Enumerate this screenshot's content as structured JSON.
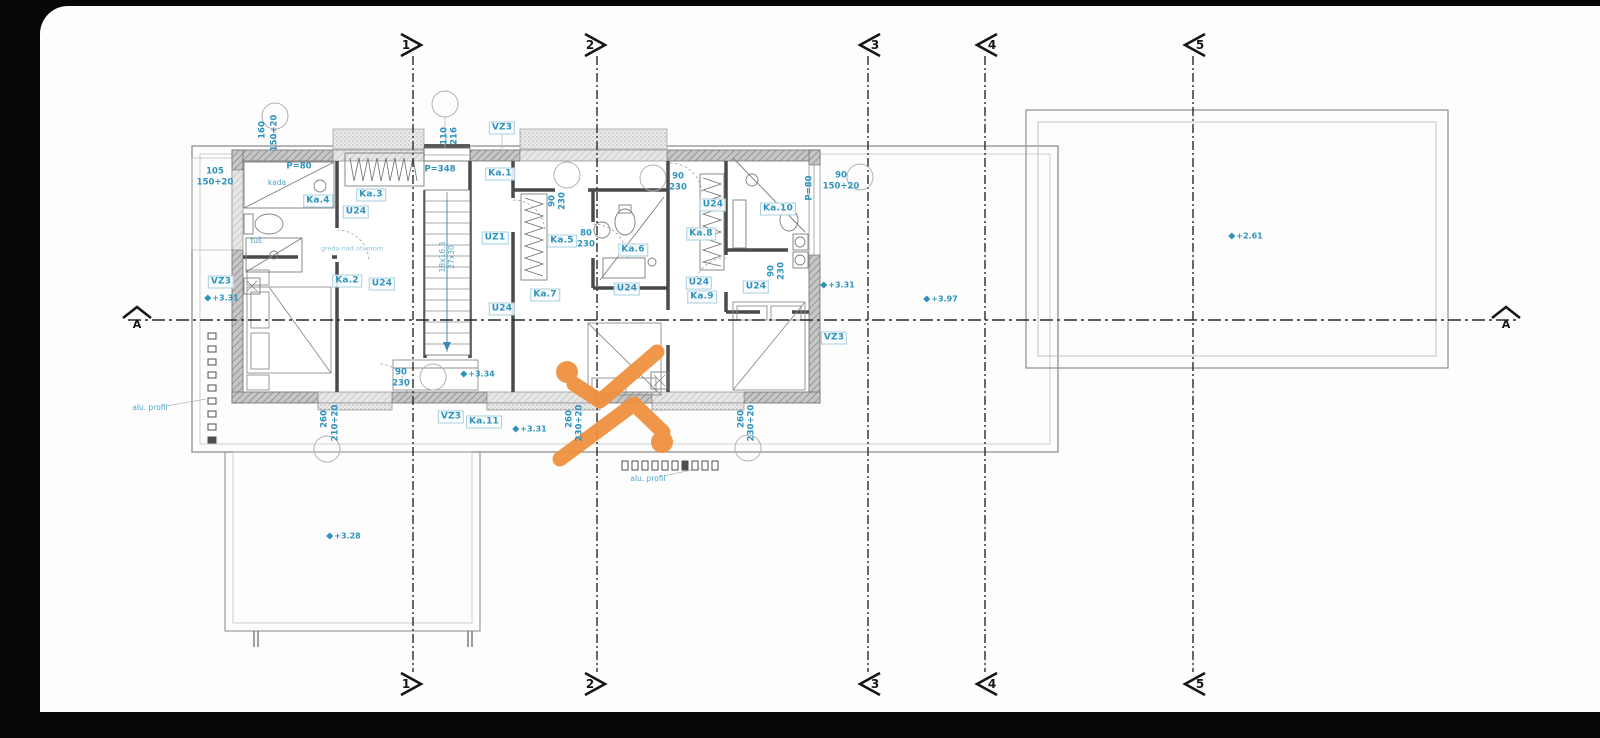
{
  "meta": {
    "drawing_type": "floor-plan",
    "annotation_color": "#2e93bd",
    "line_color": "#3c3c3c",
    "watermark_color": "#f0913f",
    "sheet_bg": "#fdfdfd",
    "frame_bg": "#060606"
  },
  "grid": {
    "vertical_axes": [
      {
        "label": "1",
        "x": 413,
        "dir": "right"
      },
      {
        "label": "2",
        "x": 597,
        "dir": "right"
      },
      {
        "label": "3",
        "x": 868,
        "dir": "left"
      },
      {
        "label": "4",
        "x": 985,
        "dir": "left"
      },
      {
        "label": "5",
        "x": 1193,
        "dir": "left"
      }
    ],
    "y_top_marker": 45,
    "y_bottom_marker": 684,
    "line_top": 56,
    "line_bottom": 672,
    "section_axis": {
      "label": "A",
      "y": 320,
      "x_start": 128,
      "x_end": 1516,
      "marker_left_x": 137,
      "marker_right_x": 1506
    }
  },
  "reference_circles": [
    {
      "x": 275,
      "y": 116
    },
    {
      "x": 445,
      "y": 104
    },
    {
      "x": 567,
      "y": 175
    },
    {
      "x": 653,
      "y": 178
    },
    {
      "x": 860,
      "y": 177
    },
    {
      "x": 433,
      "y": 377
    },
    {
      "x": 327,
      "y": 449
    },
    {
      "x": 748,
      "y": 448
    }
  ],
  "annotations": [
    {
      "text": "Ka.4",
      "x": 318,
      "y": 201,
      "style": "box"
    },
    {
      "text": "Ka.3",
      "x": 371,
      "y": 195,
      "style": "box"
    },
    {
      "text": "U24",
      "x": 356,
      "y": 212,
      "style": "box"
    },
    {
      "text": "Ka.2",
      "x": 347,
      "y": 281,
      "style": "box"
    },
    {
      "text": "U24",
      "x": 382,
      "y": 284,
      "style": "box"
    },
    {
      "text": "VZ3",
      "x": 221,
      "y": 282,
      "style": "box"
    },
    {
      "text": "Ka.1",
      "x": 500,
      "y": 174,
      "style": "box"
    },
    {
      "text": "VZ3",
      "x": 502,
      "y": 128,
      "style": "box"
    },
    {
      "text": "UZ1",
      "x": 495,
      "y": 238,
      "style": "box"
    },
    {
      "text": "U24",
      "x": 502,
      "y": 309,
      "style": "box"
    },
    {
      "text": "Ka.5",
      "x": 562,
      "y": 241,
      "style": "box"
    },
    {
      "text": "Ka.7",
      "x": 545,
      "y": 295,
      "style": "box"
    },
    {
      "text": "Ka.6",
      "x": 633,
      "y": 250,
      "style": "box"
    },
    {
      "text": "U24",
      "x": 627,
      "y": 289,
      "style": "box"
    },
    {
      "text": "U24",
      "x": 713,
      "y": 205,
      "style": "box"
    },
    {
      "text": "Ka.8",
      "x": 701,
      "y": 234,
      "style": "box"
    },
    {
      "text": "Ka.10",
      "x": 778,
      "y": 209,
      "style": "box"
    },
    {
      "text": "U24",
      "x": 756,
      "y": 287,
      "style": "box"
    },
    {
      "text": "U24",
      "x": 699,
      "y": 283,
      "style": "box"
    },
    {
      "text": "Ka.9",
      "x": 702,
      "y": 297,
      "style": "box"
    },
    {
      "text": "VZ3",
      "x": 451,
      "y": 417,
      "style": "box"
    },
    {
      "text": "Ka.11",
      "x": 484,
      "y": 422,
      "style": "box"
    },
    {
      "text": "VZ3",
      "x": 834,
      "y": 338,
      "style": "box"
    },
    {
      "text": "105",
      "x": 215,
      "y": 172,
      "style": "dim"
    },
    {
      "text": "150+20",
      "x": 215,
      "y": 183,
      "style": "dim"
    },
    {
      "text": "P=80",
      "x": 299,
      "y": 167,
      "style": "dim"
    },
    {
      "text": "P=348",
      "x": 440,
      "y": 170,
      "style": "dim"
    },
    {
      "text": "90",
      "x": 678,
      "y": 177,
      "style": "dim"
    },
    {
      "text": "230",
      "x": 678,
      "y": 188,
      "style": "dim"
    },
    {
      "text": "80",
      "x": 586,
      "y": 234,
      "style": "dim"
    },
    {
      "text": "230",
      "x": 586,
      "y": 245,
      "style": "dim"
    },
    {
      "text": "90",
      "x": 401,
      "y": 373,
      "style": "dim"
    },
    {
      "text": "230",
      "x": 401,
      "y": 384,
      "style": "dim"
    },
    {
      "text": "90",
      "x": 841,
      "y": 176,
      "style": "dim"
    },
    {
      "text": "150+20",
      "x": 841,
      "y": 187,
      "style": "dim"
    },
    {
      "text": "160",
      "x": 263,
      "y": 130,
      "style": "dim",
      "rot": true
    },
    {
      "text": "150+20",
      "x": 275,
      "y": 133,
      "style": "dim",
      "rot": true
    },
    {
      "text": "110",
      "x": 445,
      "y": 136,
      "style": "dim",
      "rot": true
    },
    {
      "text": "216",
      "x": 455,
      "y": 136,
      "style": "dim",
      "rot": true
    },
    {
      "text": "90",
      "x": 553,
      "y": 201,
      "style": "dim",
      "rot": true
    },
    {
      "text": "230",
      "x": 563,
      "y": 201,
      "style": "dim",
      "rot": true
    },
    {
      "text": "P=80",
      "x": 810,
      "y": 188,
      "style": "dim",
      "rot": true
    },
    {
      "text": "90",
      "x": 772,
      "y": 271,
      "style": "dim",
      "rot": true
    },
    {
      "text": "230",
      "x": 782,
      "y": 271,
      "style": "dim",
      "rot": true
    },
    {
      "text": "260",
      "x": 570,
      "y": 419,
      "style": "dim",
      "rot": true
    },
    {
      "text": "230+20",
      "x": 580,
      "y": 423,
      "style": "dim",
      "rot": true
    },
    {
      "text": "260",
      "x": 742,
      "y": 419,
      "style": "dim",
      "rot": true
    },
    {
      "text": "230+20",
      "x": 752,
      "y": 423,
      "style": "dim",
      "rot": true
    },
    {
      "text": "260",
      "x": 325,
      "y": 419,
      "style": "dim",
      "rot": true
    },
    {
      "text": "210+20",
      "x": 336,
      "y": 423,
      "style": "dim",
      "rot": true
    },
    {
      "text": "18x16.3",
      "x": 443,
      "y": 257,
      "style": "tiny",
      "rot": true
    },
    {
      "text": "27x30",
      "x": 452,
      "y": 257,
      "style": "tiny",
      "rot": true
    },
    {
      "text": "+3.31",
      "x": 222,
      "y": 298,
      "style": "level"
    },
    {
      "text": "+3.34",
      "x": 478,
      "y": 374,
      "style": "level"
    },
    {
      "text": "+3.31",
      "x": 530,
      "y": 429,
      "style": "level"
    },
    {
      "text": "+3.31",
      "x": 838,
      "y": 285,
      "style": "level"
    },
    {
      "text": "+3.97",
      "x": 941,
      "y": 299,
      "style": "level"
    },
    {
      "text": "+2.61",
      "x": 1246,
      "y": 236,
      "style": "level"
    },
    {
      "text": "+3.28",
      "x": 344,
      "y": 536,
      "style": "level"
    },
    {
      "text": "kada",
      "x": 277,
      "y": 183,
      "style": "tiny"
    },
    {
      "text": "tuš",
      "x": 256,
      "y": 241,
      "style": "tiny"
    },
    {
      "text": "greda nad otvorom",
      "x": 352,
      "y": 249,
      "style": "faint"
    },
    {
      "text": "alu. profil",
      "x": 150,
      "y": 408,
      "style": "tiny"
    },
    {
      "text": "alu. profil",
      "x": 648,
      "y": 479,
      "style": "tiny"
    }
  ]
}
